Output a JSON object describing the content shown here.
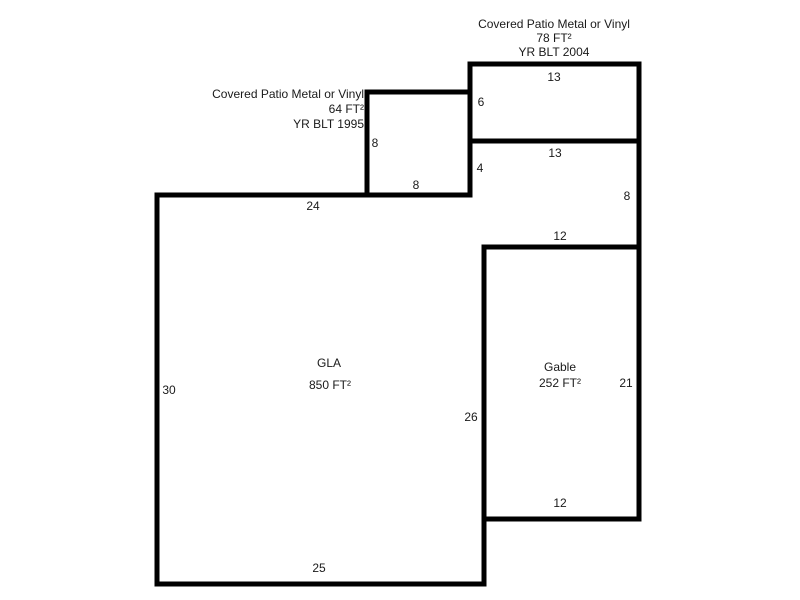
{
  "sketch": {
    "background_color": "#ffffff",
    "wall_color": "#000000",
    "text_color": "#1a1a1a",
    "patio78": {
      "line1": "Covered Patio Metal or Vinyl",
      "line2": "78 FT²",
      "line3": "YR BLT 2004",
      "dim_top": "13",
      "dim_left": "6"
    },
    "patio64": {
      "line1": "Covered Patio Metal or Vinyl",
      "line2": "64 FT²",
      "line3": "YR BLT 1995",
      "dim_left": "8",
      "dim_bottom": "8"
    },
    "connector": {
      "dim_top": "13",
      "dim_left": "4",
      "dim_right": "8"
    },
    "gla": {
      "name": "GLA",
      "area": "850 FT²",
      "dim_top": "24",
      "dim_left": "30",
      "dim_right": "26",
      "dim_bottom": "25"
    },
    "gable": {
      "name": "Gable",
      "area": "252 FT²",
      "dim_top": "12",
      "dim_right": "21",
      "dim_bottom": "12"
    }
  }
}
